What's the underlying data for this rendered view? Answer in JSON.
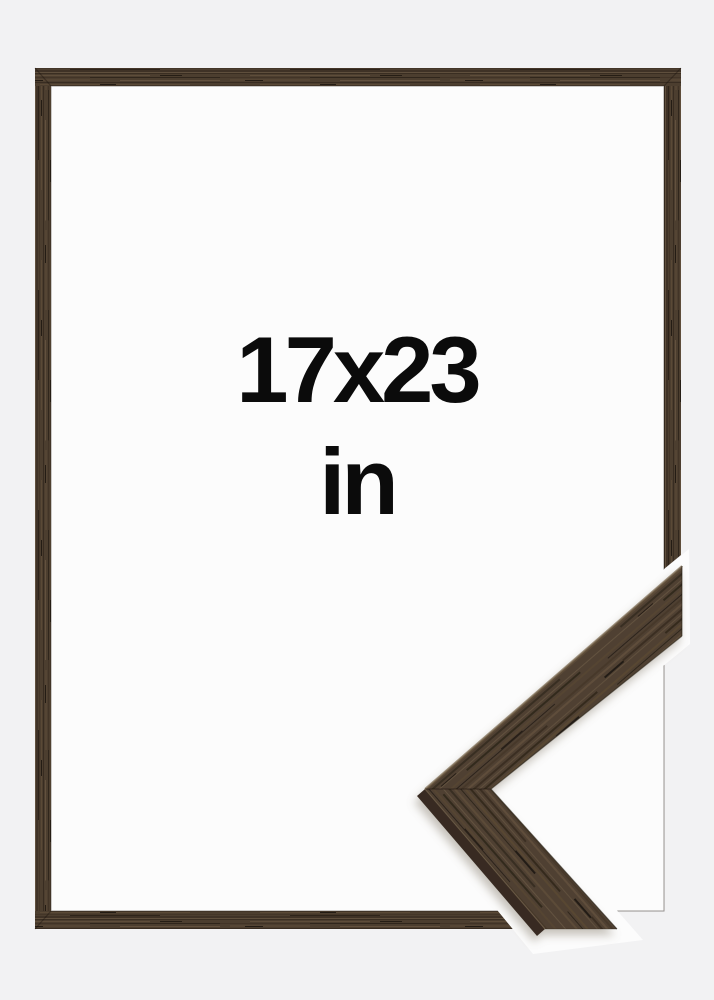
{
  "product_preview": {
    "size_label": "17x23",
    "unit_label": "in"
  },
  "colors": {
    "background": "#f2f2f3",
    "frame_interior": "#fcfcfc",
    "cutout_band": "#fcfcfc",
    "wood_base": "#4c3e2f",
    "wood_base_detail": "#4f4132",
    "wood_dark_streak": "#342a1f",
    "wood_light_streak": "#5f4e3b",
    "detail_side_facet": "#382c20",
    "text": "#0b0b0b"
  }
}
